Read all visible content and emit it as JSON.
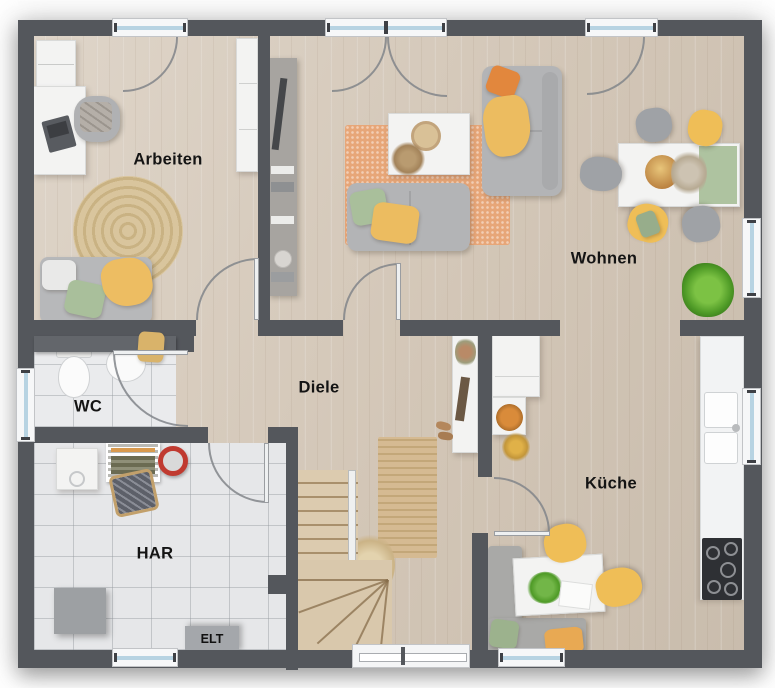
{
  "floor_plan": {
    "rooms": [
      {
        "id": "arbeiten",
        "label": "Arbeiten"
      },
      {
        "id": "wohnen",
        "label": "Wohnen"
      },
      {
        "id": "diele",
        "label": "Diele"
      },
      {
        "id": "wc",
        "label": "WC"
      },
      {
        "id": "har",
        "label": "HAR"
      },
      {
        "id": "kueche",
        "label": "Küche"
      }
    ],
    "annotations": [
      {
        "id": "elt",
        "label": "ELT"
      }
    ],
    "palette": {
      "wall": "#54575c",
      "wood_floor": "#d7cbbc",
      "tile_floor": "#e6e7e9",
      "window_glass": "#b7d3e2",
      "rug_terracotta": "#e7a678",
      "rug_jute": "#cfb48c",
      "accent_yellow": "#efbe57",
      "accent_green": "#a9bf9b",
      "accent_orange": "#e2873d",
      "sofa_gray": "#b3b4b6"
    }
  }
}
